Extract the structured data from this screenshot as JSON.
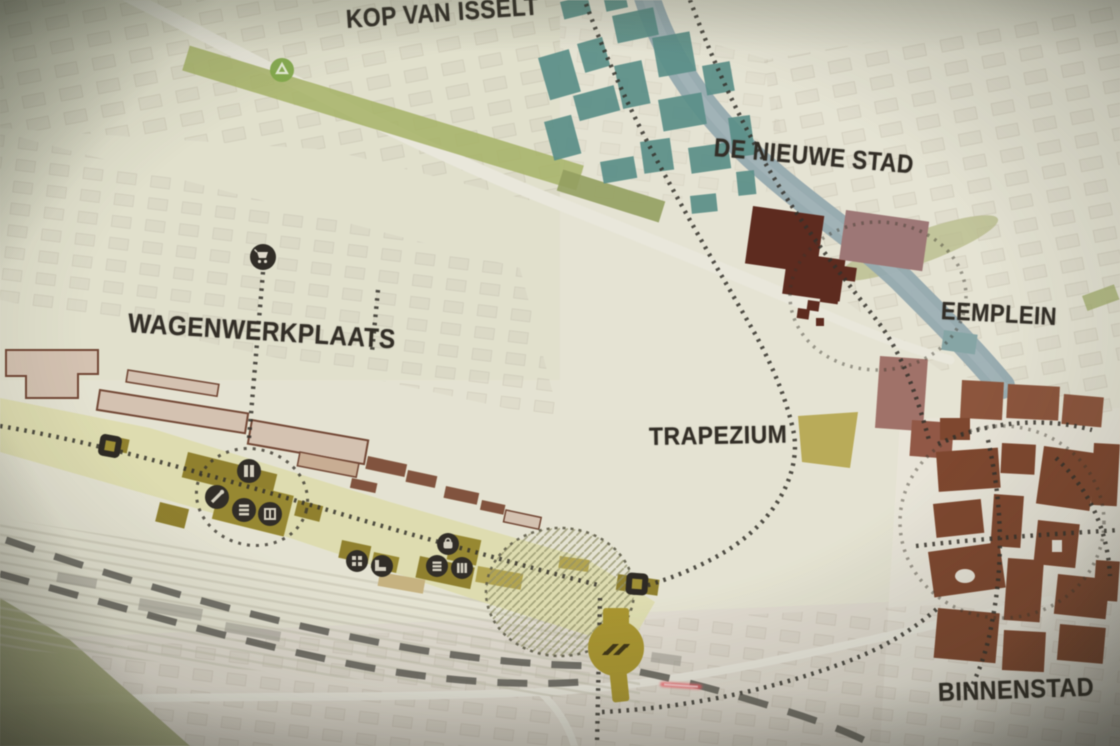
{
  "map": {
    "labels": {
      "kop_van_isselt": "KOP VAN ISSELT",
      "de_nieuwe_stad": "DE NIEUWE STAD",
      "eemplein": "EEMPLEIN",
      "wagenwerkplaats": "WAGENWERKPLAATS",
      "trapezium": "TRAPEZIUM",
      "binnenstad": "BINNENSTAD"
    },
    "icons": [
      "shopping-cart-icon",
      "recycling-icon",
      "industry-icon",
      "workshop-icon",
      "market-icon",
      "storage-icon",
      "grid-icon",
      "boot-icon",
      "bag-icon",
      "stall-icon",
      "stripes-icon",
      "site-entrance-icon-west",
      "site-entrance-icon-station",
      "ns-railway-station-icon"
    ],
    "colors": {
      "industrial_teal": "#4e8a85",
      "historic_maroon": "#551b10",
      "binnenstad_rust": "#7a3a20",
      "mauve_building": "#9c6f70",
      "development_olive": "#8c7a1d",
      "railyard_field": "#e2dfad",
      "water": "#8fa7b0",
      "green_strip": "#a3b25c",
      "route_dots": "#26231e",
      "railway_dash": "#504e48",
      "ns_station_yellow": "#a8921f",
      "shed_outline": "#6d3b28",
      "label_text": "#241f19",
      "laser_pointer_red": "#ff5560"
    }
  }
}
